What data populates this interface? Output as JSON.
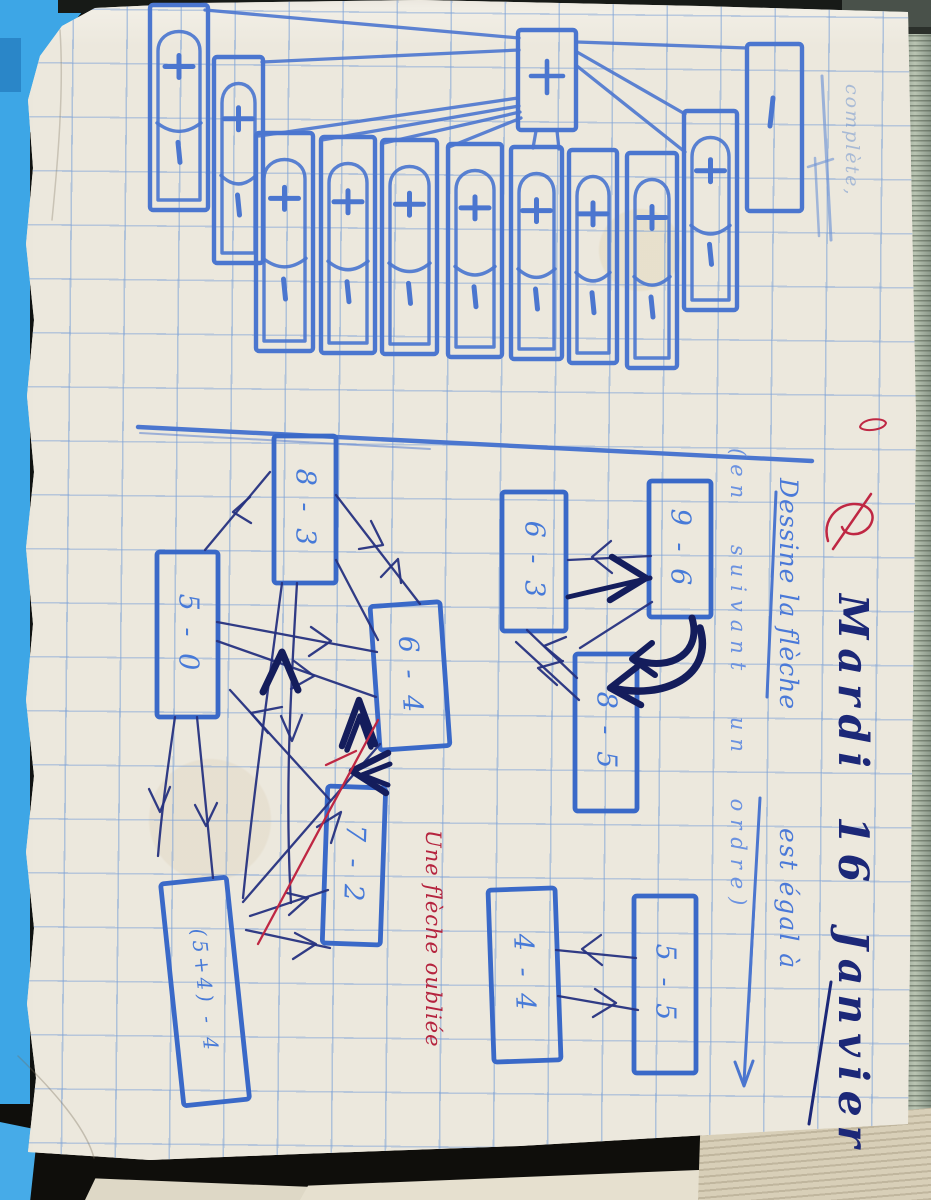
{
  "notebook": {
    "faint_header_word": "complète,",
    "date": "Mardi 16 Janvier",
    "teacher_red_mark": "L",
    "instruction_line1": "Dessine la flèche",
    "instruction_line2": "est égal à",
    "instruction_note": "(en suivant un ordre)",
    "red_annotation": "Une flèche oubliée"
  },
  "top_exercise": {
    "description": "Row of overlapping hand-drawn sign cards, each showing a plus sign above an arc and a minus sign, all linked by lines converging to one small card containing a plus sign; one extra tall card at right contains only a minus sign.",
    "plus_symbol": "+",
    "minus_symbol": "−",
    "full_card_count": 10,
    "target_card_symbol": "+",
    "single_minus_card_symbol": "−"
  },
  "arrow_graphs": {
    "left": {
      "nodes": [
        {
          "label": "8 - 3"
        },
        {
          "label": "5 - 0"
        },
        {
          "label": "6 - 4"
        },
        {
          "label": "7 - 2"
        },
        {
          "label": "(5+4) - 4"
        }
      ],
      "note": "many dark pen arrows drawn between equal-value boxes, one arrow added in red"
    },
    "right_top": {
      "nodes": [
        {
          "label": "6 - 3"
        },
        {
          "label": "9 - 6"
        },
        {
          "label": "8 - 5"
        }
      ]
    },
    "right_bottom": {
      "nodes": [
        {
          "label": "4 - 4"
        },
        {
          "label": "5 - 5"
        }
      ]
    }
  },
  "colors": {
    "marker_blue": "#4b76cf",
    "box_blue": "#3a69c8",
    "pen_navy": "#26317f",
    "bold_navy": "#141d5c",
    "text_navy": "#1c2878",
    "red_ink": "#bf2743",
    "paper": "#ece8dd",
    "grid_blue": "#9fc0e2",
    "scanner_cyan": "#3da6e6"
  }
}
